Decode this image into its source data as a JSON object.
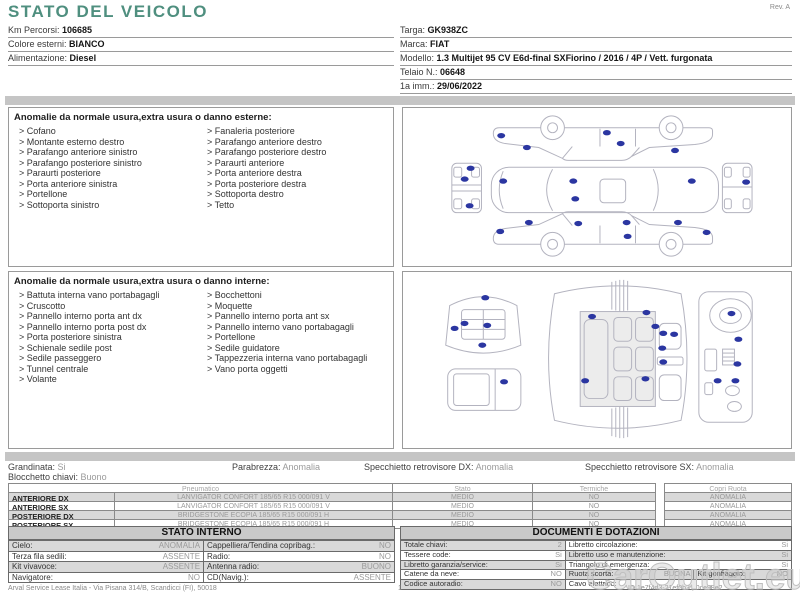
{
  "title": "STATO DEL VEICOLO",
  "rev": "Rev. A",
  "vehicle_info": {
    "left": [
      {
        "label": "Km Percorsi:",
        "value": "106685"
      },
      {
        "label": "Colore esterni:",
        "value": "BIANCO"
      },
      {
        "label": "Alimentazione:",
        "value": "Diesel"
      }
    ],
    "right": [
      {
        "label": "Targa:",
        "value": "GK938ZC"
      },
      {
        "label": "Marca:",
        "value": "FIAT"
      },
      {
        "label": "Modello:",
        "value": "1.3 Multijet 95 CV E6d-final SXFiorino / 2016 / 4P / Vett. furgonata"
      },
      {
        "label": "Telaio N.:",
        "value": "06648"
      },
      {
        "label": "1a imm.:",
        "value": "29/06/2022"
      }
    ]
  },
  "exterior": {
    "title": "Anomalie da normale usura,extra usura o danno esterne:",
    "items_left": [
      "Cofano",
      "Montante esterno destro",
      "Parafango anteriore sinistro",
      "Parafango posteriore sinistro",
      "Paraurti posteriore",
      "Porta anteriore sinistra",
      "Portellone",
      "Sottoporta sinistro"
    ],
    "items_right": [
      "Fanaleria posteriore",
      "Parafango anteriore destro",
      "Parafango posteriore destro",
      "Paraurti anteriore",
      "Porta anteriore destra",
      "Porta posteriore destra",
      "Sottoporta destro",
      "Tetto"
    ]
  },
  "interior": {
    "title": "Anomalie da normale usura,extra usura o danno interne:",
    "items_left": [
      "Battuta interna vano portabagagli",
      "Cruscotto",
      "Pannello interno porta ant dx",
      "Pannello interno porta post dx",
      "Porta posteriore sinistra",
      "Schienale sedile post",
      "Sedile passeggero",
      "Tunnel centrale",
      "Volante"
    ],
    "items_right": [
      "Bocchettoni",
      "Moquette",
      "Pannello interno porta ant sx",
      "Pannello interno vano portabagagli",
      "Portellone",
      "Sedile guidatore",
      "Tappezzeria interna vano portabagagli",
      "Vano porta oggetti"
    ]
  },
  "summary": {
    "line1": [
      {
        "label": "Grandinata:",
        "value": "Si"
      },
      {
        "label": "Parabrezza:",
        "value": "Anomalia"
      },
      {
        "label": "Specchietto retrovisore DX:",
        "value": "Anomalia"
      },
      {
        "label": "Specchietto retrovisore SX:",
        "value": "Anomalia"
      }
    ],
    "line2": [
      {
        "label": "Blocchetto chiavi:",
        "value": "Buono"
      }
    ]
  },
  "tyres": {
    "headers": [
      "Pneumatico",
      "Stato",
      "Termiche",
      "Copri Ruota"
    ],
    "rows": [
      {
        "position": "ANTERIORE DX",
        "tyre": "LANVIGATOR CONFORT 185/65 R15 000/091 V",
        "stato": "MEDIO",
        "termiche": "NO",
        "copri_ruota": "ANOMALIA"
      },
      {
        "position": "ANTERIORE SX",
        "tyre": "LANVIGATOR CONFORT 185/65 R15 000/091 V",
        "stato": "MEDIO",
        "termiche": "NO",
        "copri_ruota": "ANOMALIA"
      },
      {
        "position": "POSTERIORE DX",
        "tyre": "BRIDGESTONE ECOPIA 185/65 R15 000/091 H",
        "stato": "MEDIO",
        "termiche": "NO",
        "copri_ruota": "ANOMALIA"
      },
      {
        "position": "POSTERIORE SX",
        "tyre": "BRIDGESTONE ECOPIA 185/65 R15 000/091 H",
        "stato": "MEDIO",
        "termiche": "NO",
        "copri_ruota": "ANOMALIA"
      }
    ]
  },
  "stato_interno": {
    "title": "STATO INTERNO",
    "rows": [
      [
        {
          "label": "Cielo:",
          "value": "ANOMALIA"
        },
        {
          "label": "Cappelliera/Tendina copribag.:",
          "value": "NO"
        }
      ],
      [
        {
          "label": "Terza fila sedili:",
          "value": "ASSENTE"
        },
        {
          "label": "Radio:",
          "value": "NO"
        }
      ],
      [
        {
          "label": "Kit vivavoce:",
          "value": "ASSENTE"
        },
        {
          "label": "Antenna radio:",
          "value": "BUONO"
        }
      ],
      [
        {
          "label": "Navigatore:",
          "value": "NO"
        },
        {
          "label": "CD(Navig.):",
          "value": "ASSENTE"
        }
      ]
    ]
  },
  "documenti": {
    "title": "DOCUMENTI E DOTAZIONI",
    "rows": [
      [
        {
          "label": "Totale chiavi:",
          "value": "2"
        },
        {
          "label": "Libretto circolazione:",
          "value": "Si"
        }
      ],
      [
        {
          "label": "Tessere code:",
          "value": "Si"
        },
        {
          "label": "Libretto uso e manutenzione:",
          "value": "Si"
        }
      ],
      [
        {
          "label": "Libretto garanzia/service:",
          "value": "Si"
        },
        {
          "label": "Triangolo di emergenza:",
          "value": "Si"
        }
      ],
      [
        {
          "label": "Catene da neve:",
          "value": "NO"
        },
        {
          "label": "Ruota scorta:",
          "value": "BUONA"
        },
        {
          "label": "Kit gonfiaggio:",
          "value": "NO"
        }
      ],
      [
        {
          "label": "Codice autoradio:",
          "value": "NO"
        },
        {
          "label": "Cavo elettrico:",
          "value": ""
        }
      ]
    ]
  },
  "footer": {
    "company": "Arval Service Lease Italia - Via Pisana 314/B, Scandicci (FI), 50018",
    "page": "1",
    "doc_id": "ID 1e7f4d3-21ef0b3 , 0ce98e2"
  },
  "watermark": "CarOutlet.eu",
  "diagrams": {
    "exterior_dots": [
      [
        98,
        28
      ],
      [
        124,
        40
      ],
      [
        205,
        25
      ],
      [
        219,
        36
      ],
      [
        274,
        43
      ],
      [
        67,
        61
      ],
      [
        61,
        72
      ],
      [
        66,
        99
      ],
      [
        100,
        74
      ],
      [
        171,
        74
      ],
      [
        173,
        92
      ],
      [
        291,
        74
      ],
      [
        346,
        75
      ],
      [
        97,
        125
      ],
      [
        126,
        116
      ],
      [
        176,
        117
      ],
      [
        225,
        116
      ],
      [
        226,
        130
      ],
      [
        277,
        116
      ],
      [
        306,
        126
      ]
    ],
    "interior_dots": [
      [
        82,
        26
      ],
      [
        61,
        52
      ],
      [
        84,
        54
      ],
      [
        51,
        57
      ],
      [
        79,
        74
      ],
      [
        101,
        111
      ],
      [
        190,
        45
      ],
      [
        245,
        41
      ],
      [
        254,
        55
      ],
      [
        262,
        62
      ],
      [
        273,
        63
      ],
      [
        261,
        77
      ],
      [
        262,
        91
      ],
      [
        183,
        110
      ],
      [
        244,
        108
      ],
      [
        331,
        42
      ],
      [
        338,
        68
      ],
      [
        337,
        93
      ],
      [
        317,
        110
      ],
      [
        335,
        110
      ]
    ]
  },
  "colors": {
    "accent_teal": "#4f8f7f",
    "damage_dot": "#2b36a1",
    "separator_bar": "#c5c5c5",
    "row_shade": "#d9d9d9"
  }
}
